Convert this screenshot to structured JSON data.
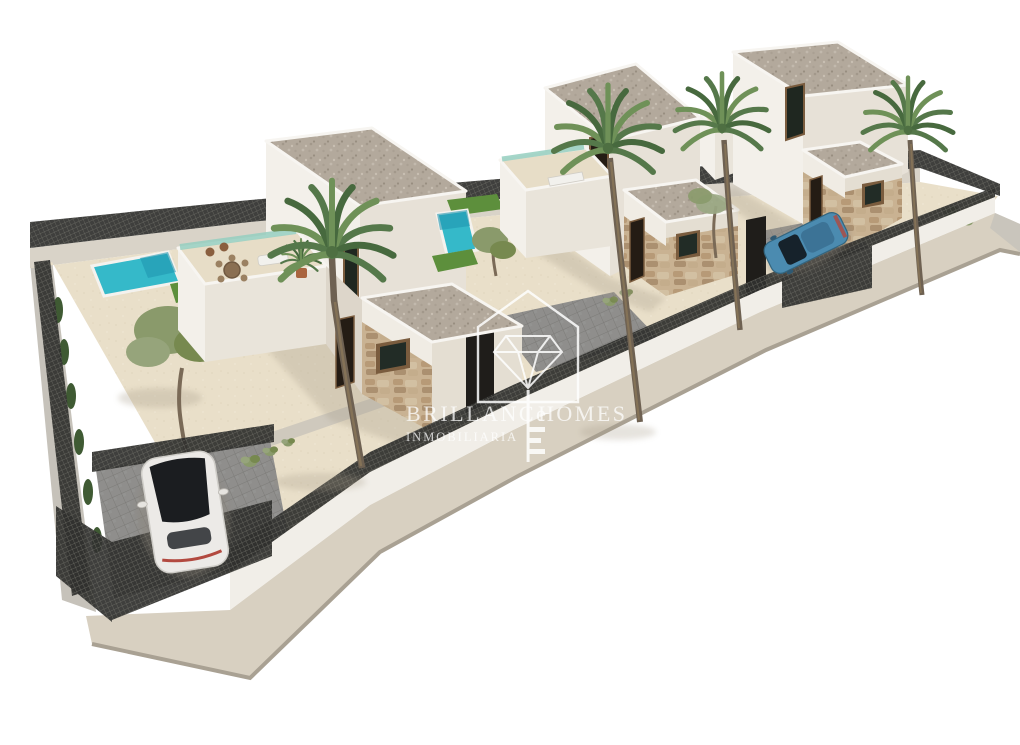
{
  "image": {
    "kind": "3d-architectural-render",
    "description": "Aerial 3D render of a diagonal row of three modern white two-storey villas with private pools, roof terraces, stone-clad facades, palm trees, dark mesh perimeter fencing, a parked white car and a parked blue car, on a plain white background",
    "background": "#ffffff"
  },
  "watermark": {
    "brand_left": "BRILLANCe",
    "brand_right": "HOMES",
    "subtitle": "INMOBILIARIA",
    "logo_icon": "diamond-house-key-icon",
    "color": "#ffffff",
    "opacity": 0.85
  },
  "scene": {
    "villa_count": 3,
    "visible_pools": 2,
    "palm_tree_count": 4,
    "cars": [
      {
        "color_name": "white",
        "body_hex": "#eceae7"
      },
      {
        "color_name": "blue",
        "body_hex": "#4b8bb0"
      }
    ]
  },
  "colors": {
    "background": "#ffffff",
    "wall_lit": "#f3f0ea",
    "wall_shaded": "#e7e1d7",
    "wall_recessed": "#ddd6ca",
    "roof_gravel": "#b3a99c",
    "stone_clad": "#c9b292",
    "sand_paving": "#e9dfc9",
    "walkway_gray": "#cfc9bd",
    "paver_gray": "#8f8e8c",
    "pool_water": "#35b9c9",
    "pool_deep": "#1f96b0",
    "lawn_green": "#5d8f3c",
    "fence_dark": "#30302e",
    "sidewalk": "#d8d0c1",
    "curb": "#a9a193",
    "street_wall_gray": "#c6c2ba",
    "palm_green": "#6f9158",
    "palm_green_dark": "#47693e",
    "olive_green": "#8a9a6b",
    "trunk_brown": "#6e6152",
    "wood_frame": "#7a5c3e",
    "glass_teal": "#96cfc0",
    "car_white": "#eceae7",
    "car_glass_dark": "#1b1d20",
    "car_blue": "#4b8bb0",
    "taillight_red": "#b2493f",
    "watermark": "#ffffff"
  }
}
